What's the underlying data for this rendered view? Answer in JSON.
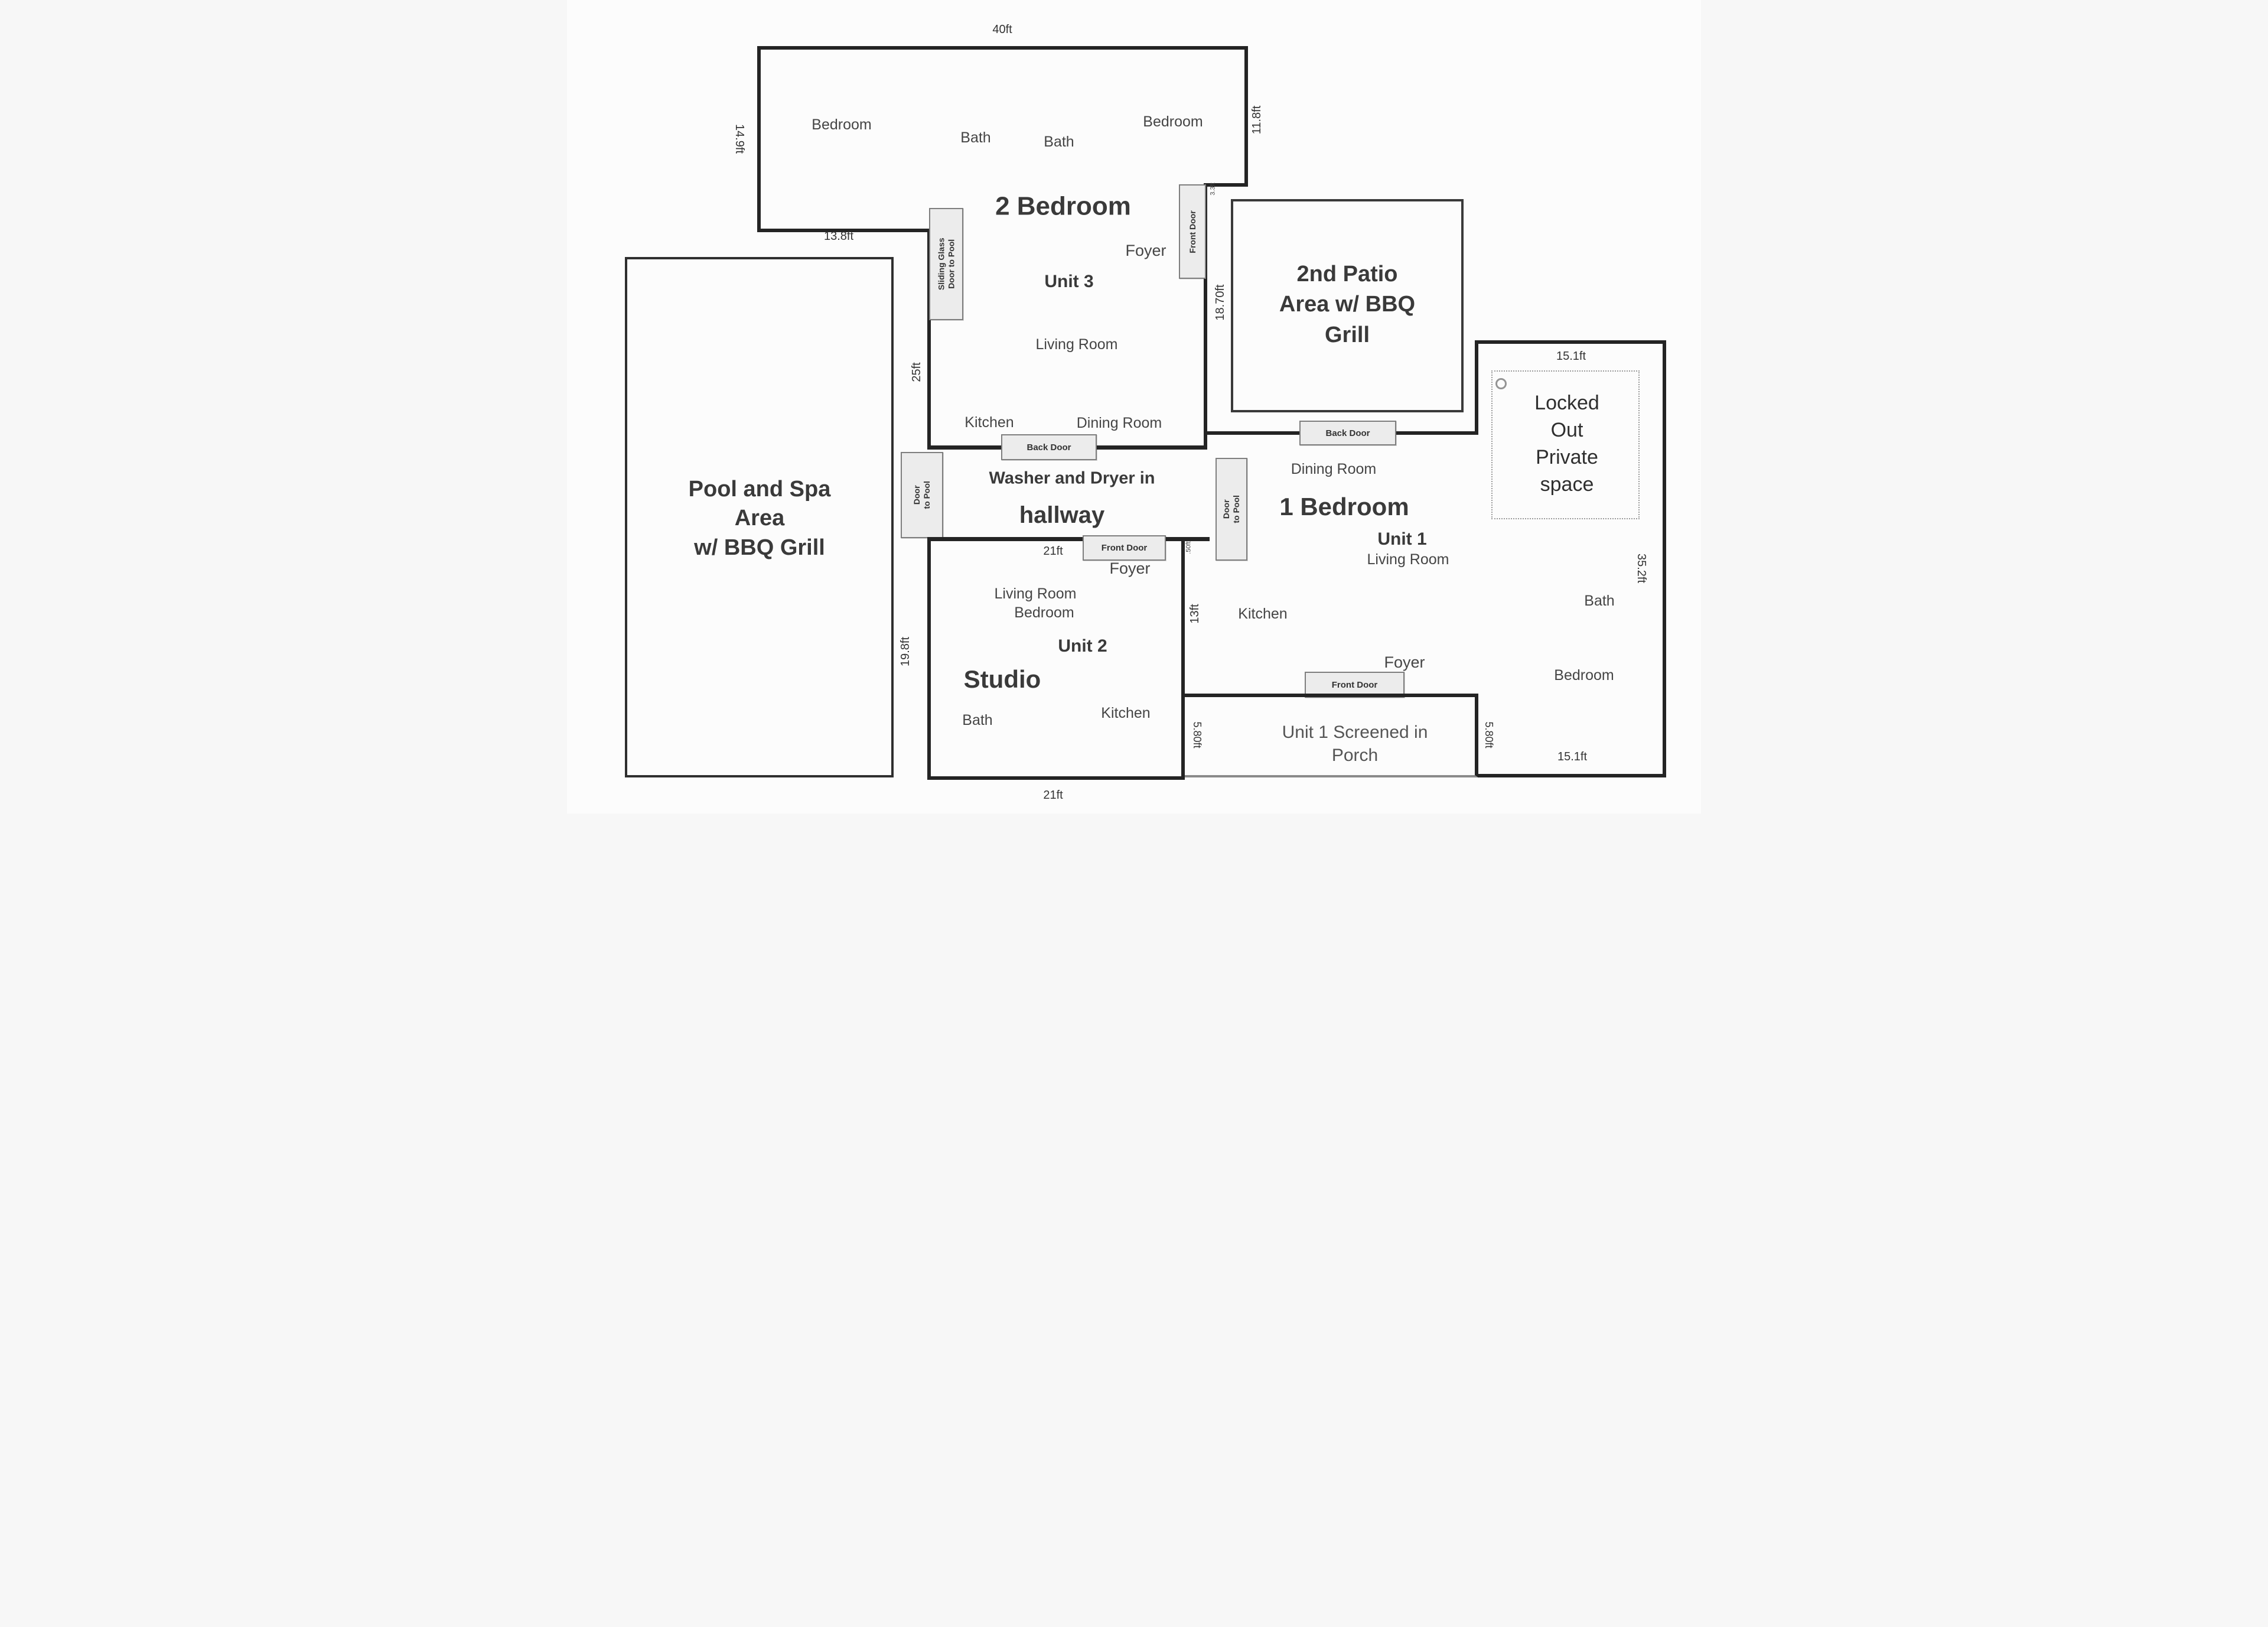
{
  "style": {
    "wall_color": "#242424",
    "door_box_bg": "#ececec",
    "door_box_border": "#7e7e7e",
    "dotted_border": "#9a9a9a"
  },
  "pool": {
    "label": "Pool and Spa\nArea\nw/ BBQ Grill"
  },
  "patio": {
    "label": "2nd Patio\nArea w/ BBQ\nGrill"
  },
  "unit3": {
    "type_label": "2 Bedroom",
    "unit_label": "Unit 3",
    "rooms": {
      "bedroom_left": "Bedroom",
      "bath_left": "Bath",
      "bath_right": "Bath",
      "bedroom_right": "Bedroom",
      "foyer": "Foyer",
      "living_room": "Living Room",
      "kitchen": "Kitchen",
      "dining_room": "Dining Room"
    },
    "doors": {
      "sliding_glass": "Sliding Glass\nDoor to Pool",
      "front": "Front Door"
    },
    "dims": {
      "top": "40ft",
      "left": "14.9ft",
      "right": "11.8ft",
      "bottom_left": "13.8ft",
      "mid_left": "25ft",
      "entry_side": "18.70ft",
      "entry_top": "3.3ft"
    }
  },
  "hallway": {
    "line1": "Washer and Dryer in",
    "line2": "hallway",
    "back_door": "Back Door",
    "door_to_pool": "Door\nto Pool",
    "dim_bottom": "21ft",
    "dim_jog": ".50ft"
  },
  "unit2": {
    "type_label": "Studio",
    "unit_label": "Unit 2",
    "rooms": {
      "foyer": "Foyer",
      "living_room": "Living Room",
      "bedroom": "Bedroom",
      "bath": "Bath",
      "kitchen": "Kitchen"
    },
    "doors": {
      "front": "Front Door"
    },
    "dims": {
      "left": "19.8ft",
      "bottom": "21ft",
      "right": "13ft"
    }
  },
  "unit1": {
    "type_label": "1 Bedroom",
    "unit_label": "Unit 1",
    "rooms": {
      "dining_room": "Dining Room",
      "living_room": "Living Room",
      "kitchen": "Kitchen",
      "foyer": "Foyer"
    },
    "doors": {
      "back": "Back Door",
      "front": "Front Door",
      "door_to_pool": "Door\nto Pool"
    }
  },
  "porch": {
    "label": "Unit 1 Screened in\nPorch",
    "dims": {
      "left": "5.80ft",
      "right": "5.80ft",
      "bottom_right": "15.1ft"
    }
  },
  "locked_wing": {
    "label": "Locked\nOut\nPrivate\nspace",
    "rooms": {
      "bath": "Bath",
      "bedroom": "Bedroom"
    },
    "dims": {
      "top": "15.1ft",
      "right": "35.2ft"
    }
  }
}
